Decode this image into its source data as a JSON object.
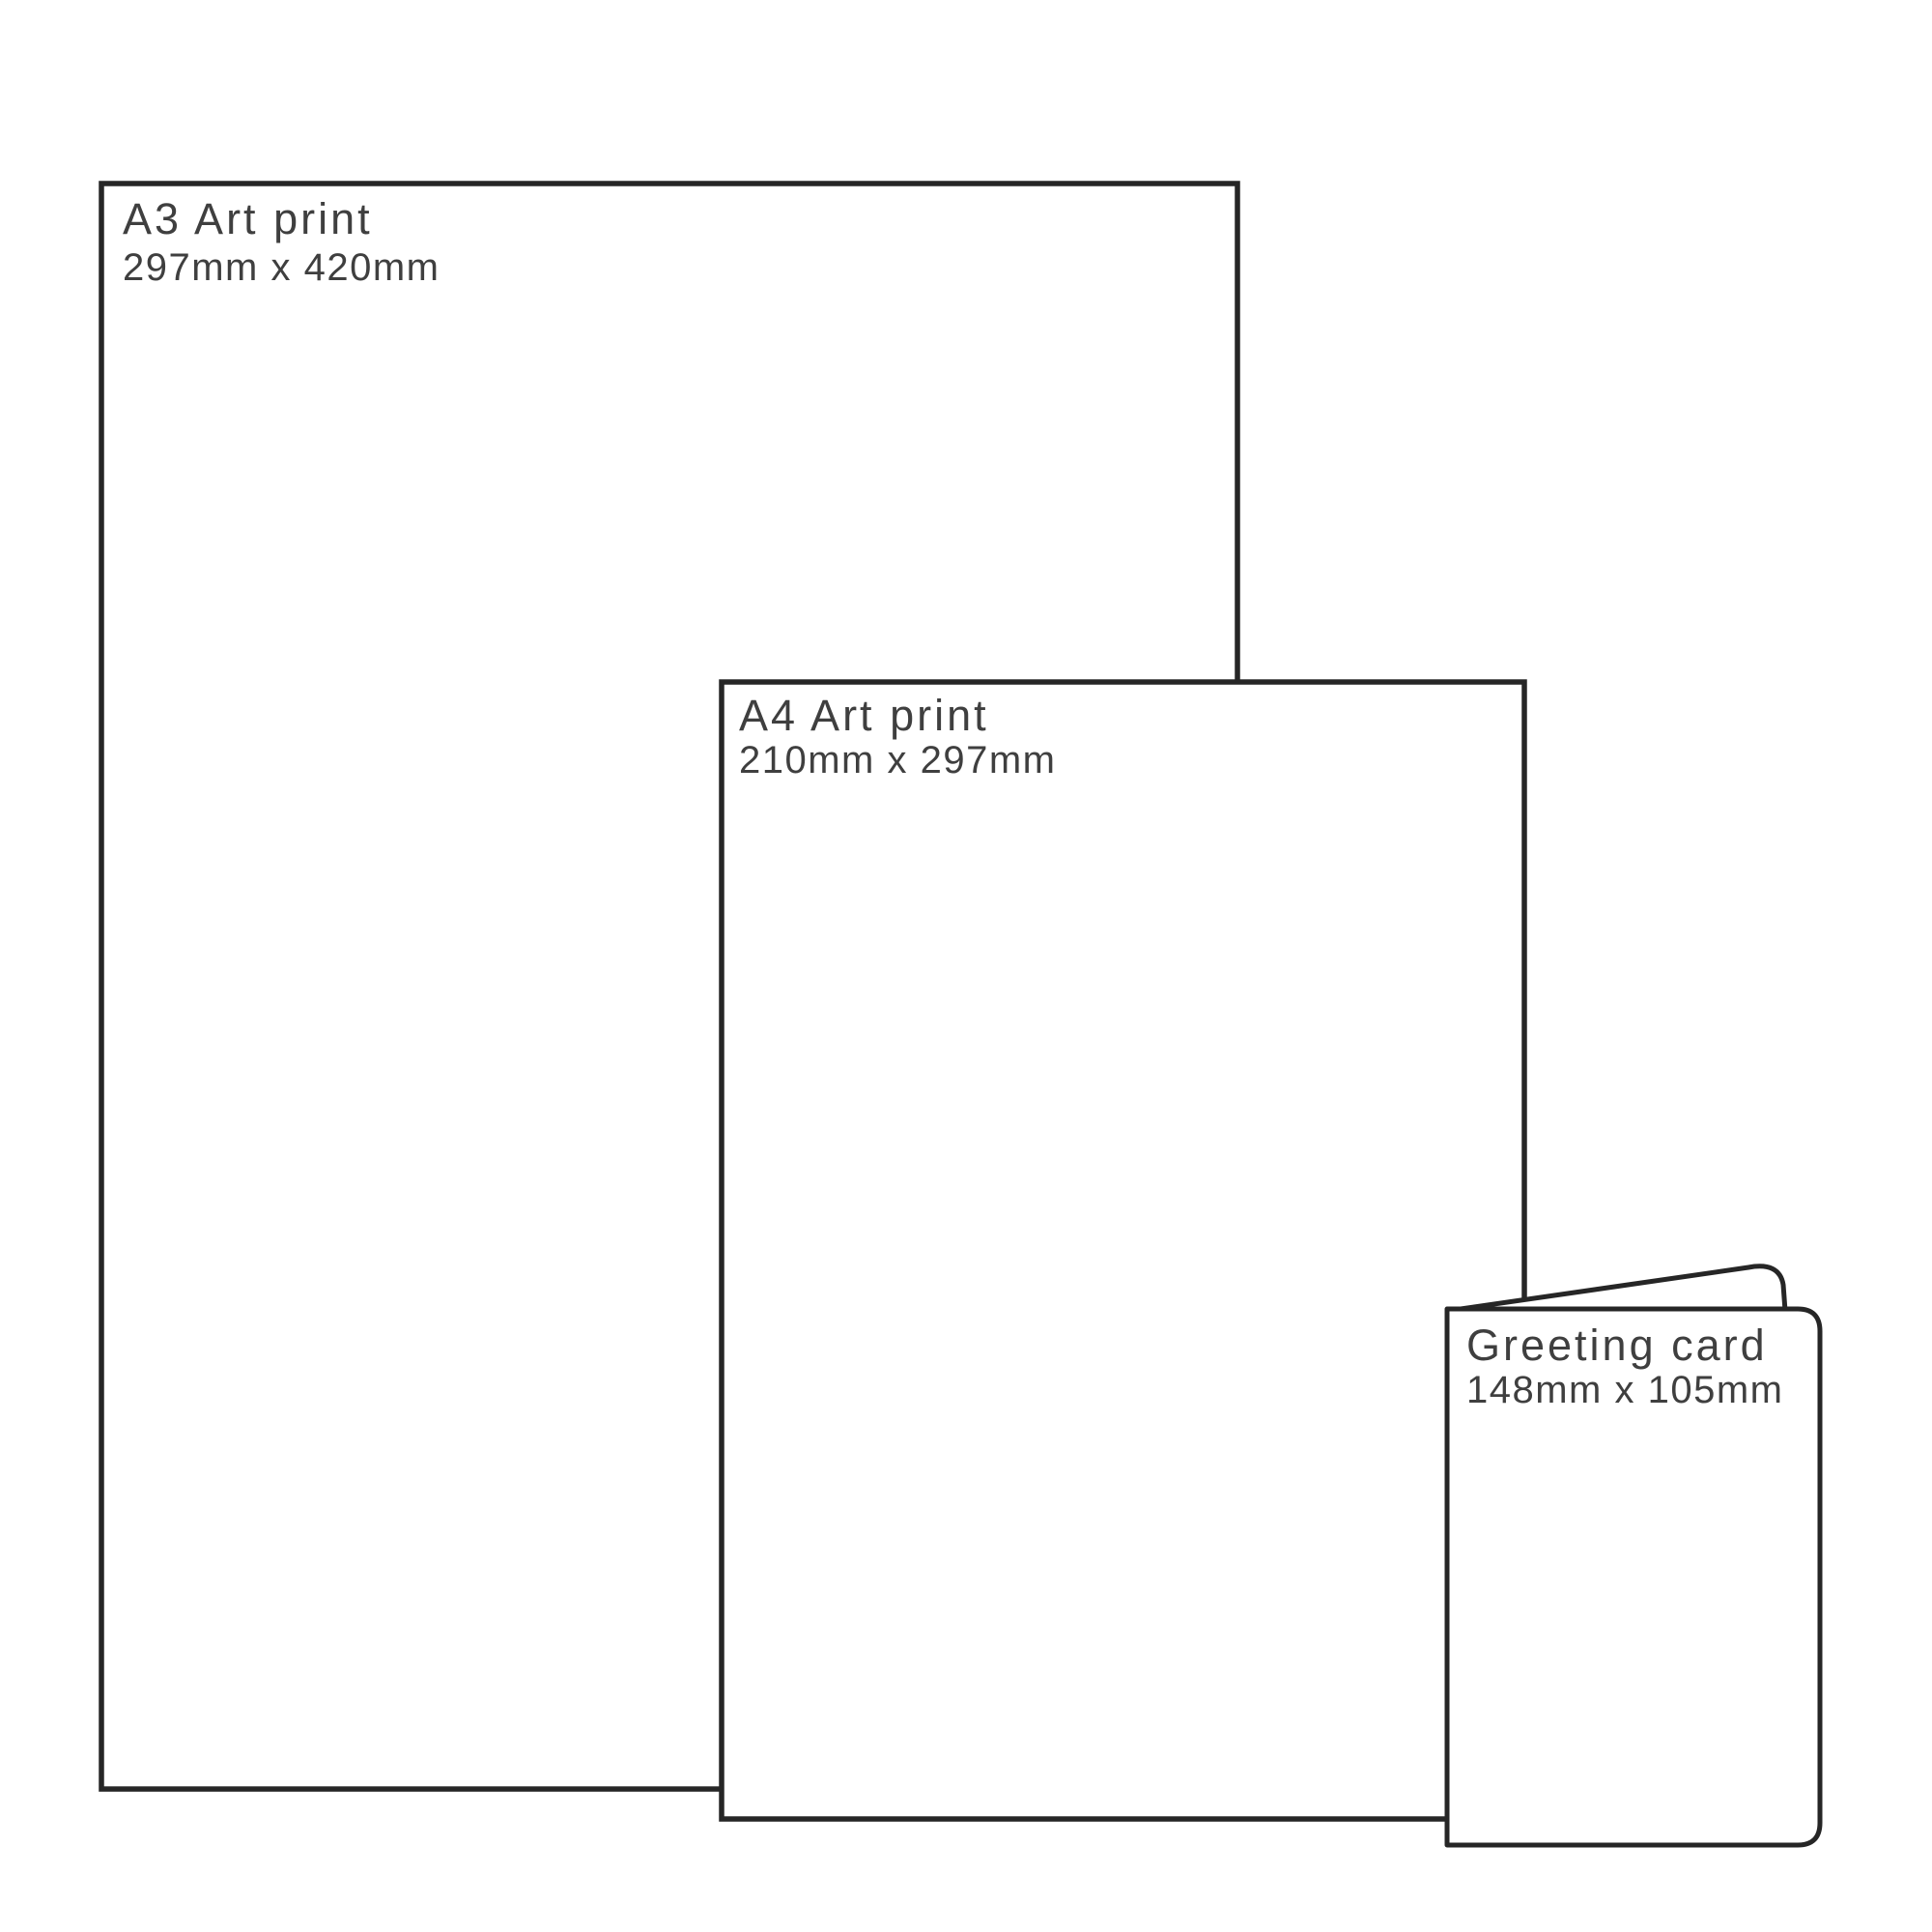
{
  "diagram": {
    "description_label": "print size comparison",
    "colors": {
      "outline": "#262626",
      "label": "#3f3f3f",
      "paper": "#ffffff"
    },
    "items": [
      {
        "id": "a3-art-print",
        "label": "A3 Art print",
        "dimensions": "297mm x 420mm"
      },
      {
        "id": "a4-art-print",
        "label": "A4 Art print",
        "dimensions": "210mm x 297mm"
      },
      {
        "id": "greeting-card",
        "label": "Greeting card",
        "dimensions": "148mm x 105mm"
      }
    ]
  }
}
